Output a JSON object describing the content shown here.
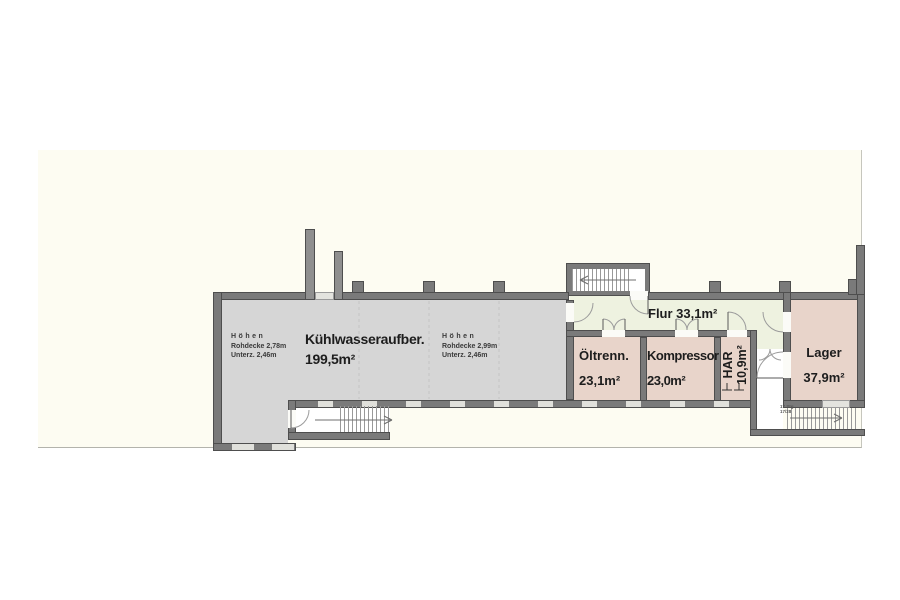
{
  "plan": {
    "rooms": {
      "kuehlwasser": {
        "name": "Kühlwasseraufber.",
        "area": "199,5m²"
      },
      "flur": {
        "label": "Flur 33,1m²"
      },
      "oeltrenn": {
        "name": "Öltrenn.",
        "area": "23,1m²"
      },
      "kompressor": {
        "name": "Kompressor",
        "area": "23,0m²"
      },
      "har": {
        "name": "HAR",
        "area": "10,9m²"
      },
      "lager": {
        "name": "Lager",
        "area": "37,9m²"
      }
    },
    "annotations": {
      "hoehen_left": {
        "title": "Höhen",
        "rohdecke": "Rohdecke 2,78m",
        "unterzug": "Unterz.  2,46m"
      },
      "hoehen_right": {
        "title": "Höhen",
        "rohdecke": "Rohdecke 2,99m",
        "unterzug": "Unterz.  2,46m"
      },
      "stair_note": {
        "line1": "17 Stg",
        "line2": "17/28"
      }
    },
    "colors": {
      "wall": "#7a7a7a",
      "room_gray": "#d6d6d6",
      "room_pink": "#e8d4ca",
      "room_green": "#eef2e0",
      "paper": "#fdfcf2"
    }
  }
}
